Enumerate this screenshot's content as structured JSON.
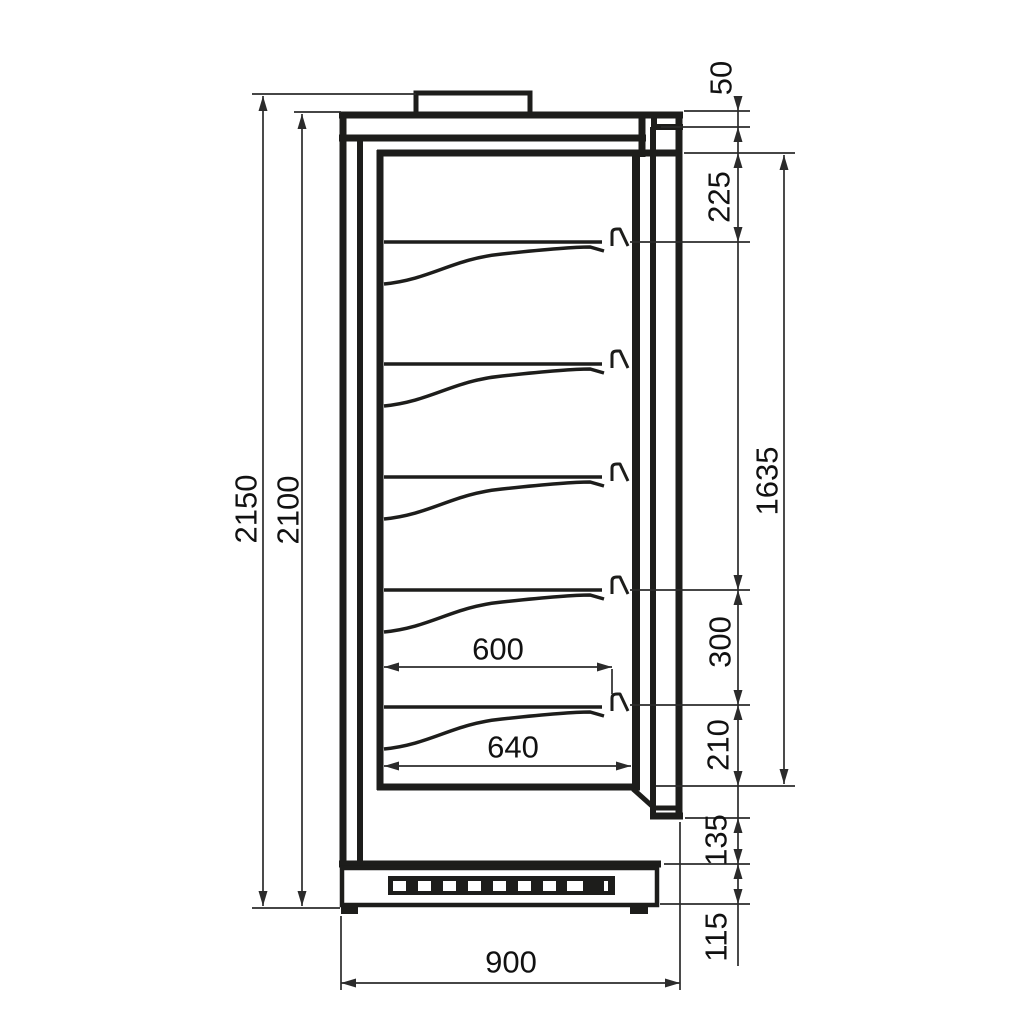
{
  "drawing": {
    "description": "Side cross-section technical drawing of a refrigerated wall display cabinet with five cantilever shelves and dimension lines",
    "background": "#ffffff",
    "line_color": "#1d1d1b",
    "dim_color": "#2b2b2b",
    "shelf_count": 5,
    "labels": {
      "overall_height": "2150",
      "body_height": "2100",
      "canopy_height": "50",
      "top_to_first_shelf": "225",
      "interior_height": "1635",
      "shelf_gap": "300",
      "last_shelf_to_floor": "210",
      "lower_panel_height": "135",
      "base_height": "115",
      "shelf_depth": "600",
      "interior_depth": "640",
      "overall_depth": "900"
    }
  }
}
